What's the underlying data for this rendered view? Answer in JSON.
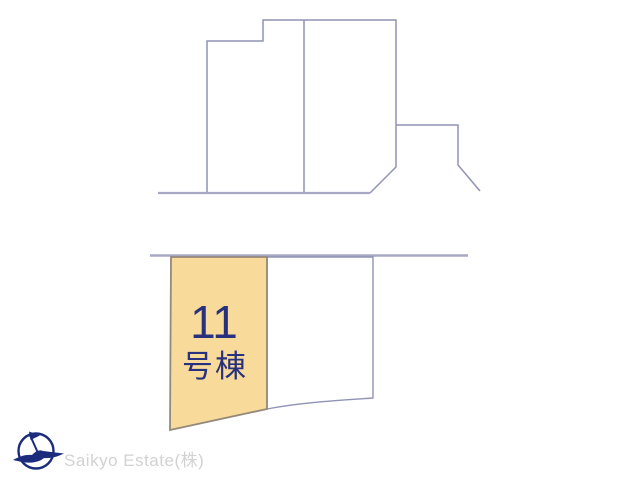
{
  "site_plan": {
    "highlighted_lot": {
      "number": "11",
      "suffix": "号棟",
      "full_label": "11号棟"
    },
    "colors": {
      "lot_fill": "#F8DB9A",
      "lot_border": "#95897C",
      "label_text": "#27317D",
      "plot_line": "#9093B6",
      "road_line": "#A7A8C4"
    }
  },
  "footer": {
    "brand": "Saikyo Estate(株)",
    "brand_color": "#D2D2D2",
    "logo_icon": "compass-bird-icon",
    "logo_color": "#1B2C7D"
  }
}
